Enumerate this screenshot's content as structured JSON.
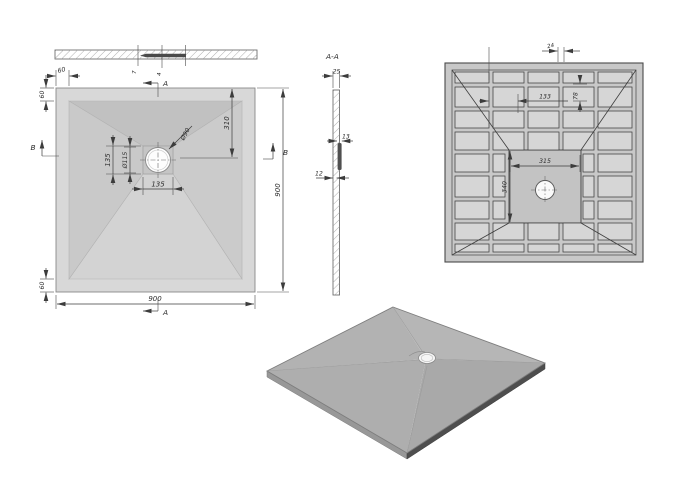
{
  "plan_view": {
    "overall_width": "900",
    "overall_height": "900",
    "flange_width_top": "60",
    "flange_height_left": "60",
    "flange_height_bottom": "60",
    "drain_center_from_top": "310",
    "drain_hole_diameter": "Ø90",
    "drain_flange_diameter": "Ø115",
    "drain_recess_width": "135",
    "drain_recess_height": "135",
    "section_marker_top": "A",
    "section_marker_bottom": "A",
    "section_marker_left": "B",
    "section_marker_right": "B"
  },
  "edge_view": {
    "depth_dim_1": "7",
    "depth_dim_2": "4"
  },
  "section_view": {
    "label": "A-A",
    "rim_thickness": "25",
    "boss_thickness": "13",
    "plate_thickness": "12"
  },
  "bottom_view": {
    "rib_gap": "24",
    "rib_span": "133",
    "rib_offset": "78",
    "recess_width": "315",
    "recess_height": "340"
  },
  "colors": {
    "body_light": "#d8d8d8",
    "body_shadow": "#c1c1c1",
    "body_mid": "#cbcbcb",
    "bottom_frame": "#c8c8c8",
    "pocket": "#d6d6d6",
    "center_recess": "#c3c3c3",
    "iso_top": "#b1b1b1",
    "iso_edge_dark": "#4e4e4e",
    "dim_line": "#3c3c3c"
  }
}
